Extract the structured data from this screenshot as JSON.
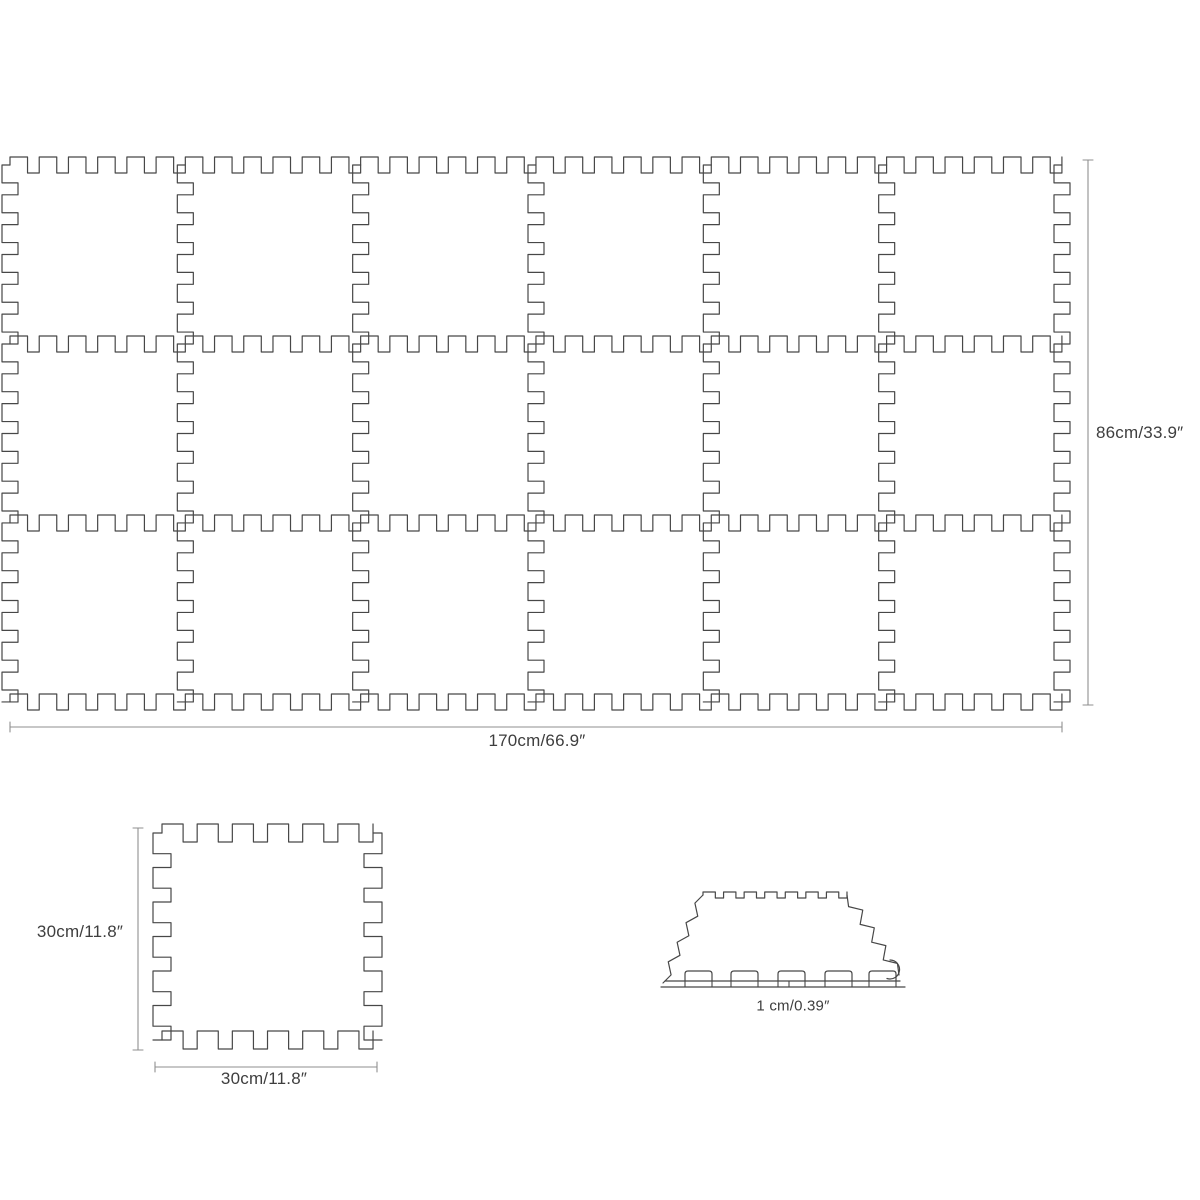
{
  "diagram": {
    "title": "interlocking foam mat dimensions",
    "grid": {
      "rows": 3,
      "cols": 6,
      "width_label": "170cm/66.9″",
      "height_label": "86cm/33.9″"
    },
    "tile": {
      "width_label": "30cm/11.8″",
      "height_label": "30cm/11.8″"
    },
    "side_view": {
      "thickness_label": "1 cm/0.39″"
    },
    "colors": {
      "outline": "#474747",
      "dimension": "#8f8f8f",
      "text": "#3e3e3e",
      "background": "#ffffff"
    }
  }
}
